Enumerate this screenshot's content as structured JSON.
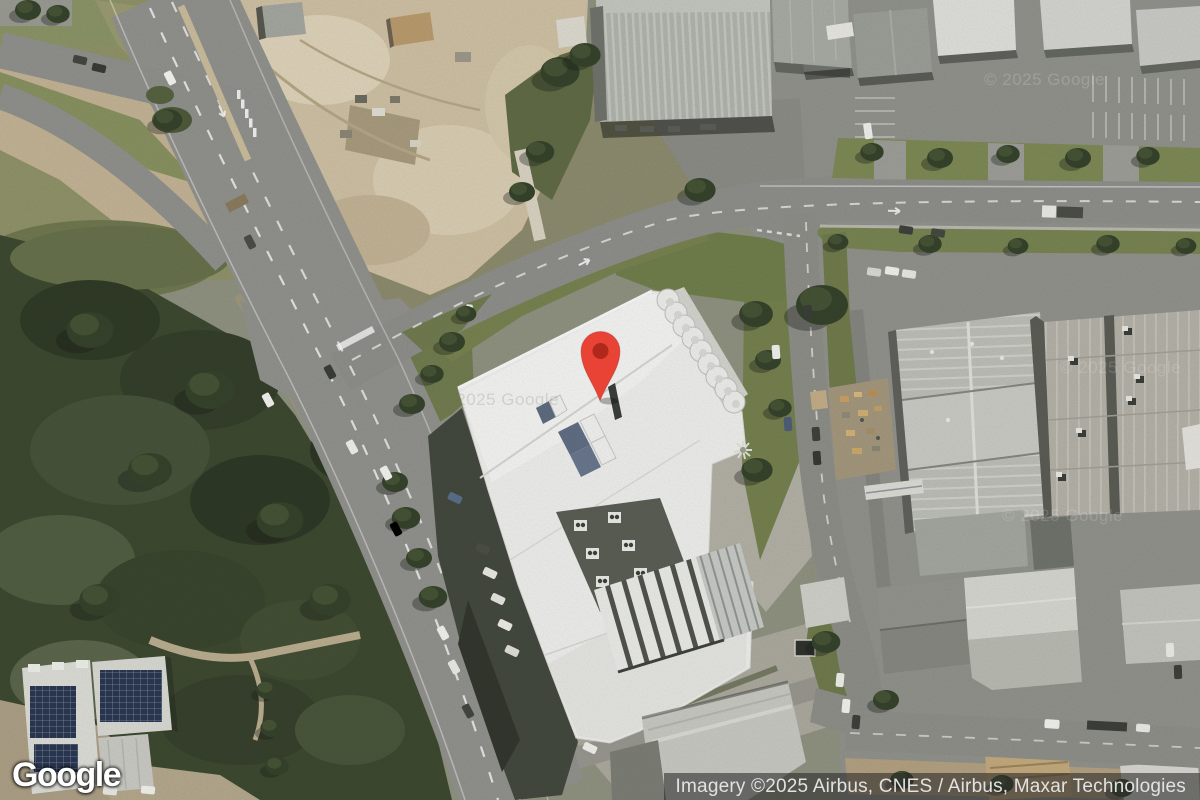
{
  "branding": {
    "logo_text": "Google"
  },
  "attribution": {
    "text": "Imagery ©2025 Airbus, CNES / Airbus, Maxar Technologies"
  },
  "watermark": {
    "text": "© 2025 Google"
  },
  "marker": {
    "icon": "map-pin-icon",
    "pin_color": "#E84335",
    "dot_color": "#B0281C"
  }
}
